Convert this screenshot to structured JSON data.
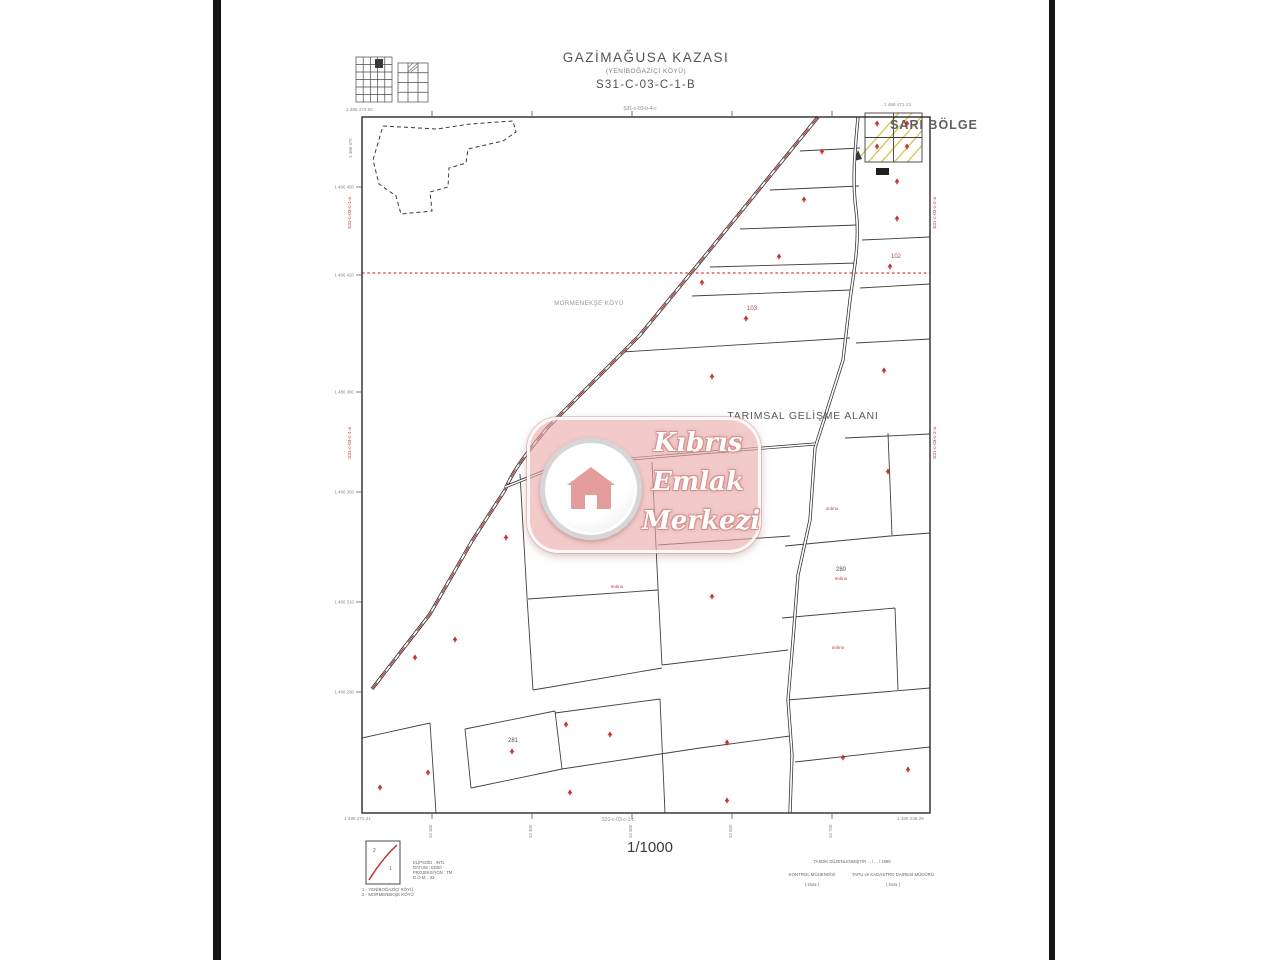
{
  "header": {
    "district": "GAZİMAĞUSA KAZASI",
    "village": "(YENİBOĞAZİÇİ KÖYÜ)",
    "sheet": "S31-C-03-C-1-B"
  },
  "map": {
    "place_labels": [
      {
        "t": "MORMENEKŞE KÖYÜ",
        "x": 589,
        "y": 305,
        "s": 6,
        "c": "#9b9090",
        "ls": 0.5
      },
      {
        "t": "TARIMSAL GELİŞME ALANI",
        "x": 803,
        "y": 419,
        "s": 10.5,
        "c": "#5a5a5a",
        "ls": 0.8
      },
      {
        "t": "SARI BÖLGE",
        "x": 934,
        "y": 129,
        "s": 12.5,
        "c": "#5f5f5f",
        "ls": 1,
        "w": "600"
      }
    ],
    "parcel_numbers": [
      {
        "t": "103",
        "x": 752,
        "y": 310,
        "s": 6,
        "c": "#a84848"
      },
      {
        "t": "102",
        "x": 896,
        "y": 258,
        "s": 6,
        "c": "#a84848"
      },
      {
        "t": "281",
        "x": 724,
        "y": 524,
        "s": 6,
        "c": "#4f4f4f"
      },
      {
        "t": "280",
        "x": 841,
        "y": 571,
        "s": 6,
        "c": "#4f4f4f"
      },
      {
        "t": "281",
        "x": 513,
        "y": 742,
        "s": 6,
        "c": "#4f4f4f"
      }
    ],
    "red_annotations": [
      {
        "t": "ınıİınıı",
        "x": 832,
        "y": 510
      },
      {
        "t": "ınıİınıı",
        "x": 841,
        "y": 580
      },
      {
        "t": "ınıİınıı",
        "x": 838,
        "y": 649
      },
      {
        "t": "ınıİınıı",
        "x": 617,
        "y": 588
      }
    ],
    "adjacent_sheets": {
      "top": "S31-c-03-b-4-c",
      "bottom": "S31-c-03-c-1-c",
      "left": "S31-c-03-c-1-a",
      "right": "S31-c-03-c-2-a"
    },
    "corner_coords": {
      "tl": "1 486 472.00",
      "tr": "1 486 471.13",
      "br": "1 486 236.26",
      "bl": "1 486 272.21",
      "tl_vertical": "1 486 470"
    },
    "left_coords": [
      {
        "t": "1 486 450",
        "y": 187
      },
      {
        "t": "1 486 420",
        "y": 275
      },
      {
        "t": "1 486 380",
        "y": 392
      },
      {
        "t": "1 486 350",
        "y": 492
      },
      {
        "t": "1 486 310",
        "y": 602
      },
      {
        "t": "1 486 280",
        "y": 692
      }
    ],
    "bottom_coords": [
      {
        "t": "43 300",
        "x": 432
      },
      {
        "t": "43 400",
        "x": 532
      },
      {
        "t": "43 500",
        "x": 632
      },
      {
        "t": "43 600",
        "x": 732
      },
      {
        "t": "43 700",
        "x": 832
      }
    ],
    "trees": [
      [
        822,
        151
      ],
      [
        804,
        199
      ],
      [
        779,
        256
      ],
      [
        702,
        282
      ],
      [
        746,
        318
      ],
      [
        890,
        266
      ],
      [
        897,
        181
      ],
      [
        897,
        218
      ],
      [
        877,
        123
      ],
      [
        907,
        123
      ],
      [
        877,
        146
      ],
      [
        907,
        146
      ],
      [
        884,
        370
      ],
      [
        712,
        376
      ],
      [
        888,
        471
      ],
      [
        625,
        518
      ],
      [
        506,
        537
      ],
      [
        712,
        596
      ],
      [
        455,
        639
      ],
      [
        415,
        657
      ],
      [
        566,
        724
      ],
      [
        512,
        751
      ],
      [
        610,
        734
      ],
      [
        727,
        742
      ],
      [
        843,
        757
      ],
      [
        908,
        769
      ],
      [
        428,
        772
      ],
      [
        380,
        787
      ],
      [
        570,
        792
      ],
      [
        727,
        800
      ]
    ]
  },
  "legend": {
    "box_labels": [
      "2",
      "1"
    ],
    "rows": [
      "ELİPSOİD : INTL",
      "DATUM : ED50",
      "PROJEKSİYON : TM",
      "D.O.M. : 33"
    ],
    "villages": [
      "1 - YENİBOĞAZİÇİ KÖYÜ",
      "2 - MORMENEKŞE KÖYÜ"
    ]
  },
  "scale": {
    "text": "1/1000"
  },
  "signature": {
    "approval": "TASDİK   DÜZENLENMİŞTİR   ... / ... / 1999",
    "left_title": "KONTROL MÜHENDİSİ",
    "left_name": "( imza )",
    "right_title": "TAPU ve KADASTRO DAİRESİ MÜDÜRÜ",
    "right_name": "( imza )"
  },
  "watermark": {
    "line1": "Kıbrıs",
    "line2": "Emlak",
    "line3": "Merkezi"
  },
  "colors": {
    "red": "#c03030",
    "annotation_red": "#c03535",
    "yellow": "#d6c44e",
    "pink": "#e9a8a8",
    "line": "#404040",
    "frame": "#2b2b2b"
  }
}
